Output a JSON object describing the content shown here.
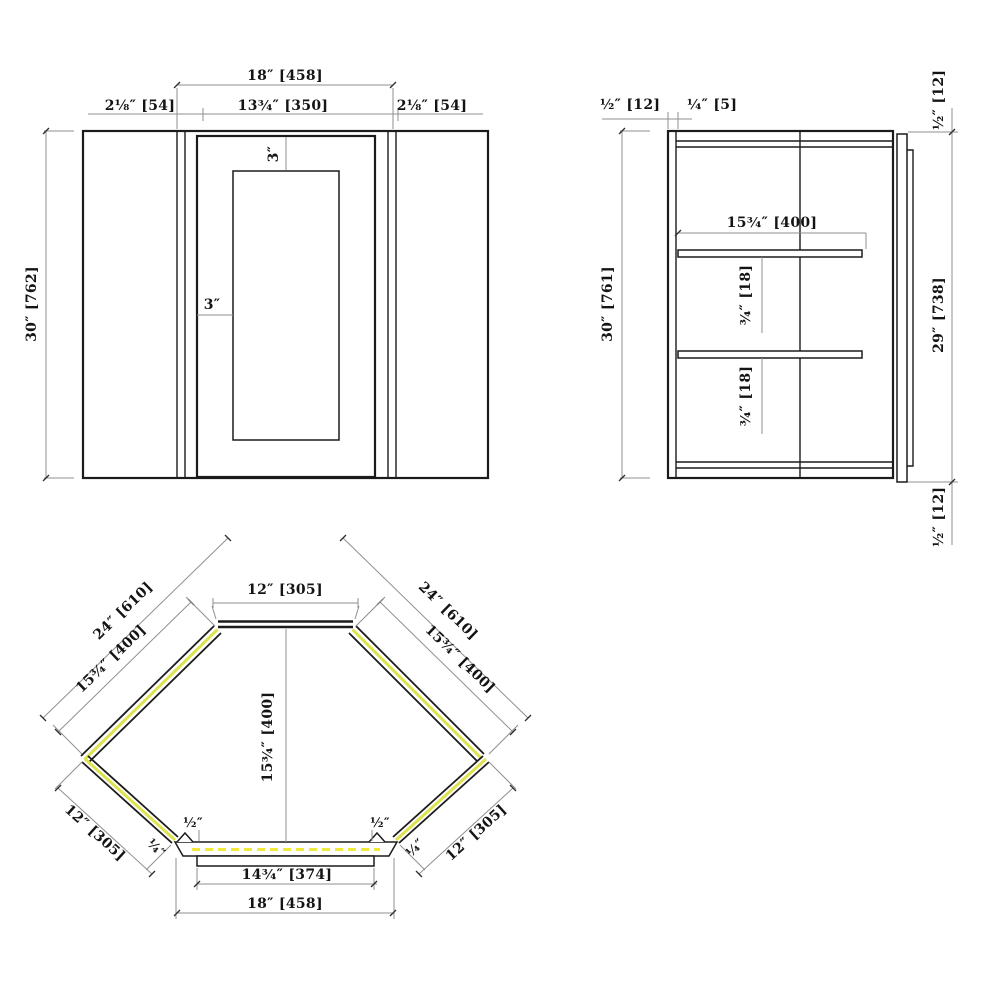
{
  "colors": {
    "line": "#1b1b1b",
    "dim": "#8f8f8f",
    "accent": "#dde24f",
    "dash": "#efe93c",
    "bg": "#ffffff",
    "text": "#141414"
  },
  "front_view": {
    "overall_width": "18″ [458]",
    "stile_left": "2⅛″ [54]",
    "door_width": "13¾″ [350]",
    "stile_right": "2⅛″ [54]",
    "height": "30″ [762]",
    "reveal_top": "3″",
    "reveal_side": "3″"
  },
  "side_view": {
    "back_thickness": "½″ [12]",
    "hang_rail": "¼″ [5]",
    "height": "30″ [761]",
    "shelf_depth": "15¾″ [400]",
    "shelf_thickness_upper": "¾″ [18]",
    "shelf_thickness_lower": "¾″ [18]",
    "door_top_reveal": "½″ [12]",
    "door_height": "29″ [738]",
    "door_bottom_reveal": "½″ [12]"
  },
  "plan_view": {
    "back_width": "12″ [305]",
    "wall_left": "24″ [610]",
    "wall_right": "24″ [610]",
    "panel_left": "15¾″ [400]",
    "panel_right": "15¾″ [400]",
    "interior_depth": "15¾″ [400]",
    "side_left": "12″ [305]",
    "side_right": "12″ [305]",
    "stile_left": "½″",
    "stile_right": "½″",
    "return_left": "¼″",
    "return_right": "¼″",
    "door_width": "14¾″ [374]",
    "front_width": "18″ [458]"
  }
}
